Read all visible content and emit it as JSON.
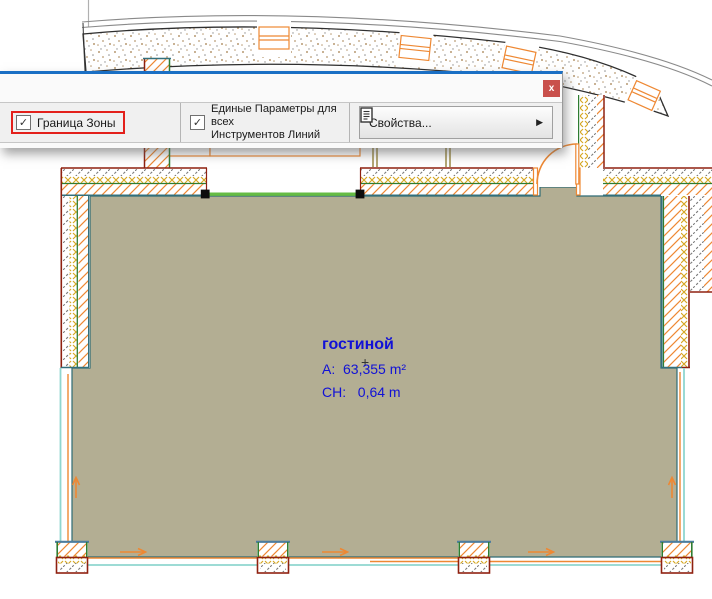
{
  "dialog": {
    "close_button": "x",
    "zone_boundary": {
      "label": "Граница Зоны",
      "checked": true,
      "highlighted": true
    },
    "uniform_params": {
      "line1": "Единые Параметры для всех",
      "line2": "Инструментов Линий",
      "checked": true
    },
    "properties_button": {
      "label": "Свойства..."
    }
  },
  "icons": {
    "checkmark": "✓",
    "submenu_arrow": "▶",
    "zone_marker": "+"
  },
  "room": {
    "name": "гостиной",
    "area": "A:  63,355 m²",
    "height": "CH:   0,64 m"
  },
  "colors": {
    "highlight_red": "#e3201b",
    "close_red": "#c9504c",
    "dialog_accent_blue": "#1a6fc4",
    "zone_fill_tan": "#b3ae93",
    "selected_edge_green": "#66bb44",
    "label_blue": "#1111d6",
    "wall_outline_red": "#8f2110",
    "hatch_orange": "#ee8833",
    "glass_cyan": "#8fd6cf"
  }
}
